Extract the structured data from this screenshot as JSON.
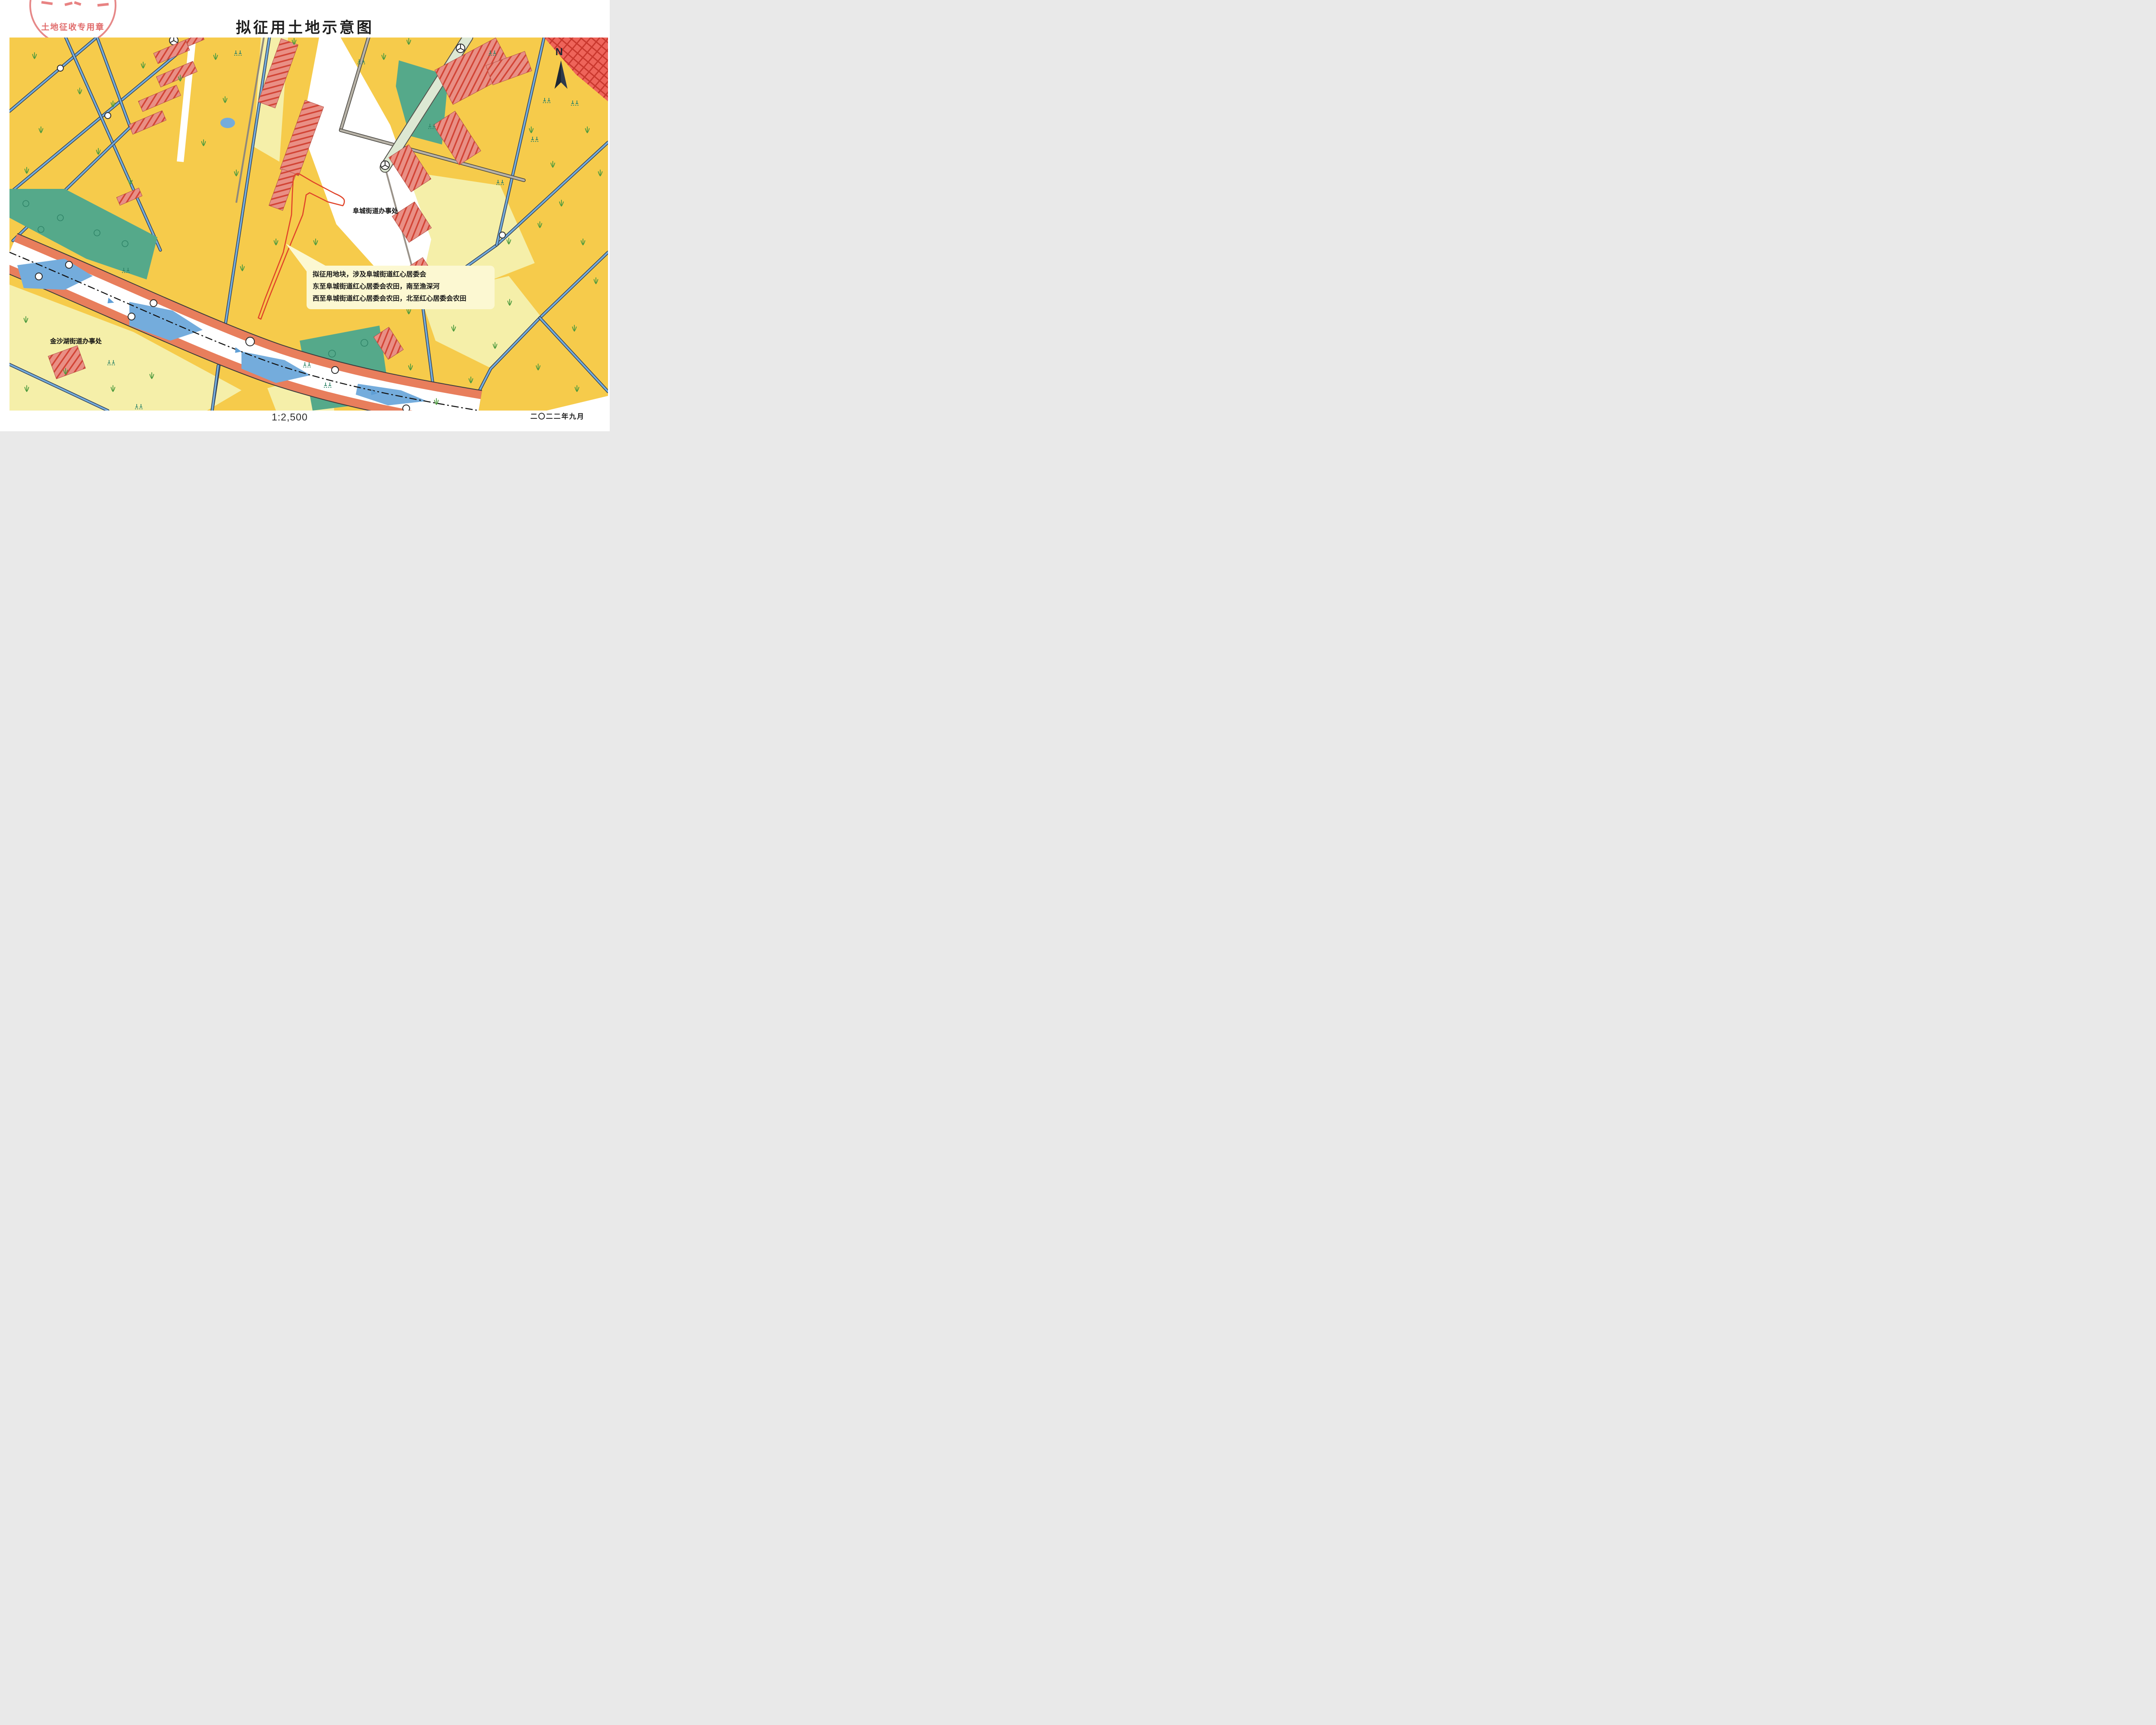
{
  "page": {
    "title": "拟征用土地示意图"
  },
  "seal": {
    "text": "土地征收专用章"
  },
  "compass": {
    "label": "N"
  },
  "map": {
    "office_labels": {
      "fucheng": "阜城街道办事处",
      "jinshahu": "金沙湖街道办事处"
    },
    "annotation": {
      "line1": "拟征用地块，涉及阜城街道红心居委会",
      "line2": "东至阜城街道红心居委会农田，南至渔深河",
      "line3": "西至阜城街道红心居委会农田，北至红心居委会农田"
    }
  },
  "footer": {
    "scale_text": "1:2,500",
    "date_text": "二〇二二年九月"
  },
  "colors": {
    "farmYellow": "#F6CB4B",
    "paleField": "#F5EFA9",
    "orchardGreen": "#55A98A",
    "symbolGreen": "#2F8468",
    "grassGreen": "#4C9A3E",
    "waterBlue": "#74ACDC",
    "canalEdge": "#2E3D55",
    "embankOrange": "#E87E5C",
    "buildingSalmon": "#E98F85",
    "hatchRed": "#D24435",
    "zoneRed": "#EE645A",
    "zoneRedLine": "#C9382E",
    "roadGray": "#B7B2A7",
    "roadGreen": "#DDE8D3",
    "parcelOutlineRed": "#E0442A",
    "sealRed": "#E06A6A",
    "annotationCream": "#FCF8D2",
    "inkBlack": "#1C1C1C"
  }
}
